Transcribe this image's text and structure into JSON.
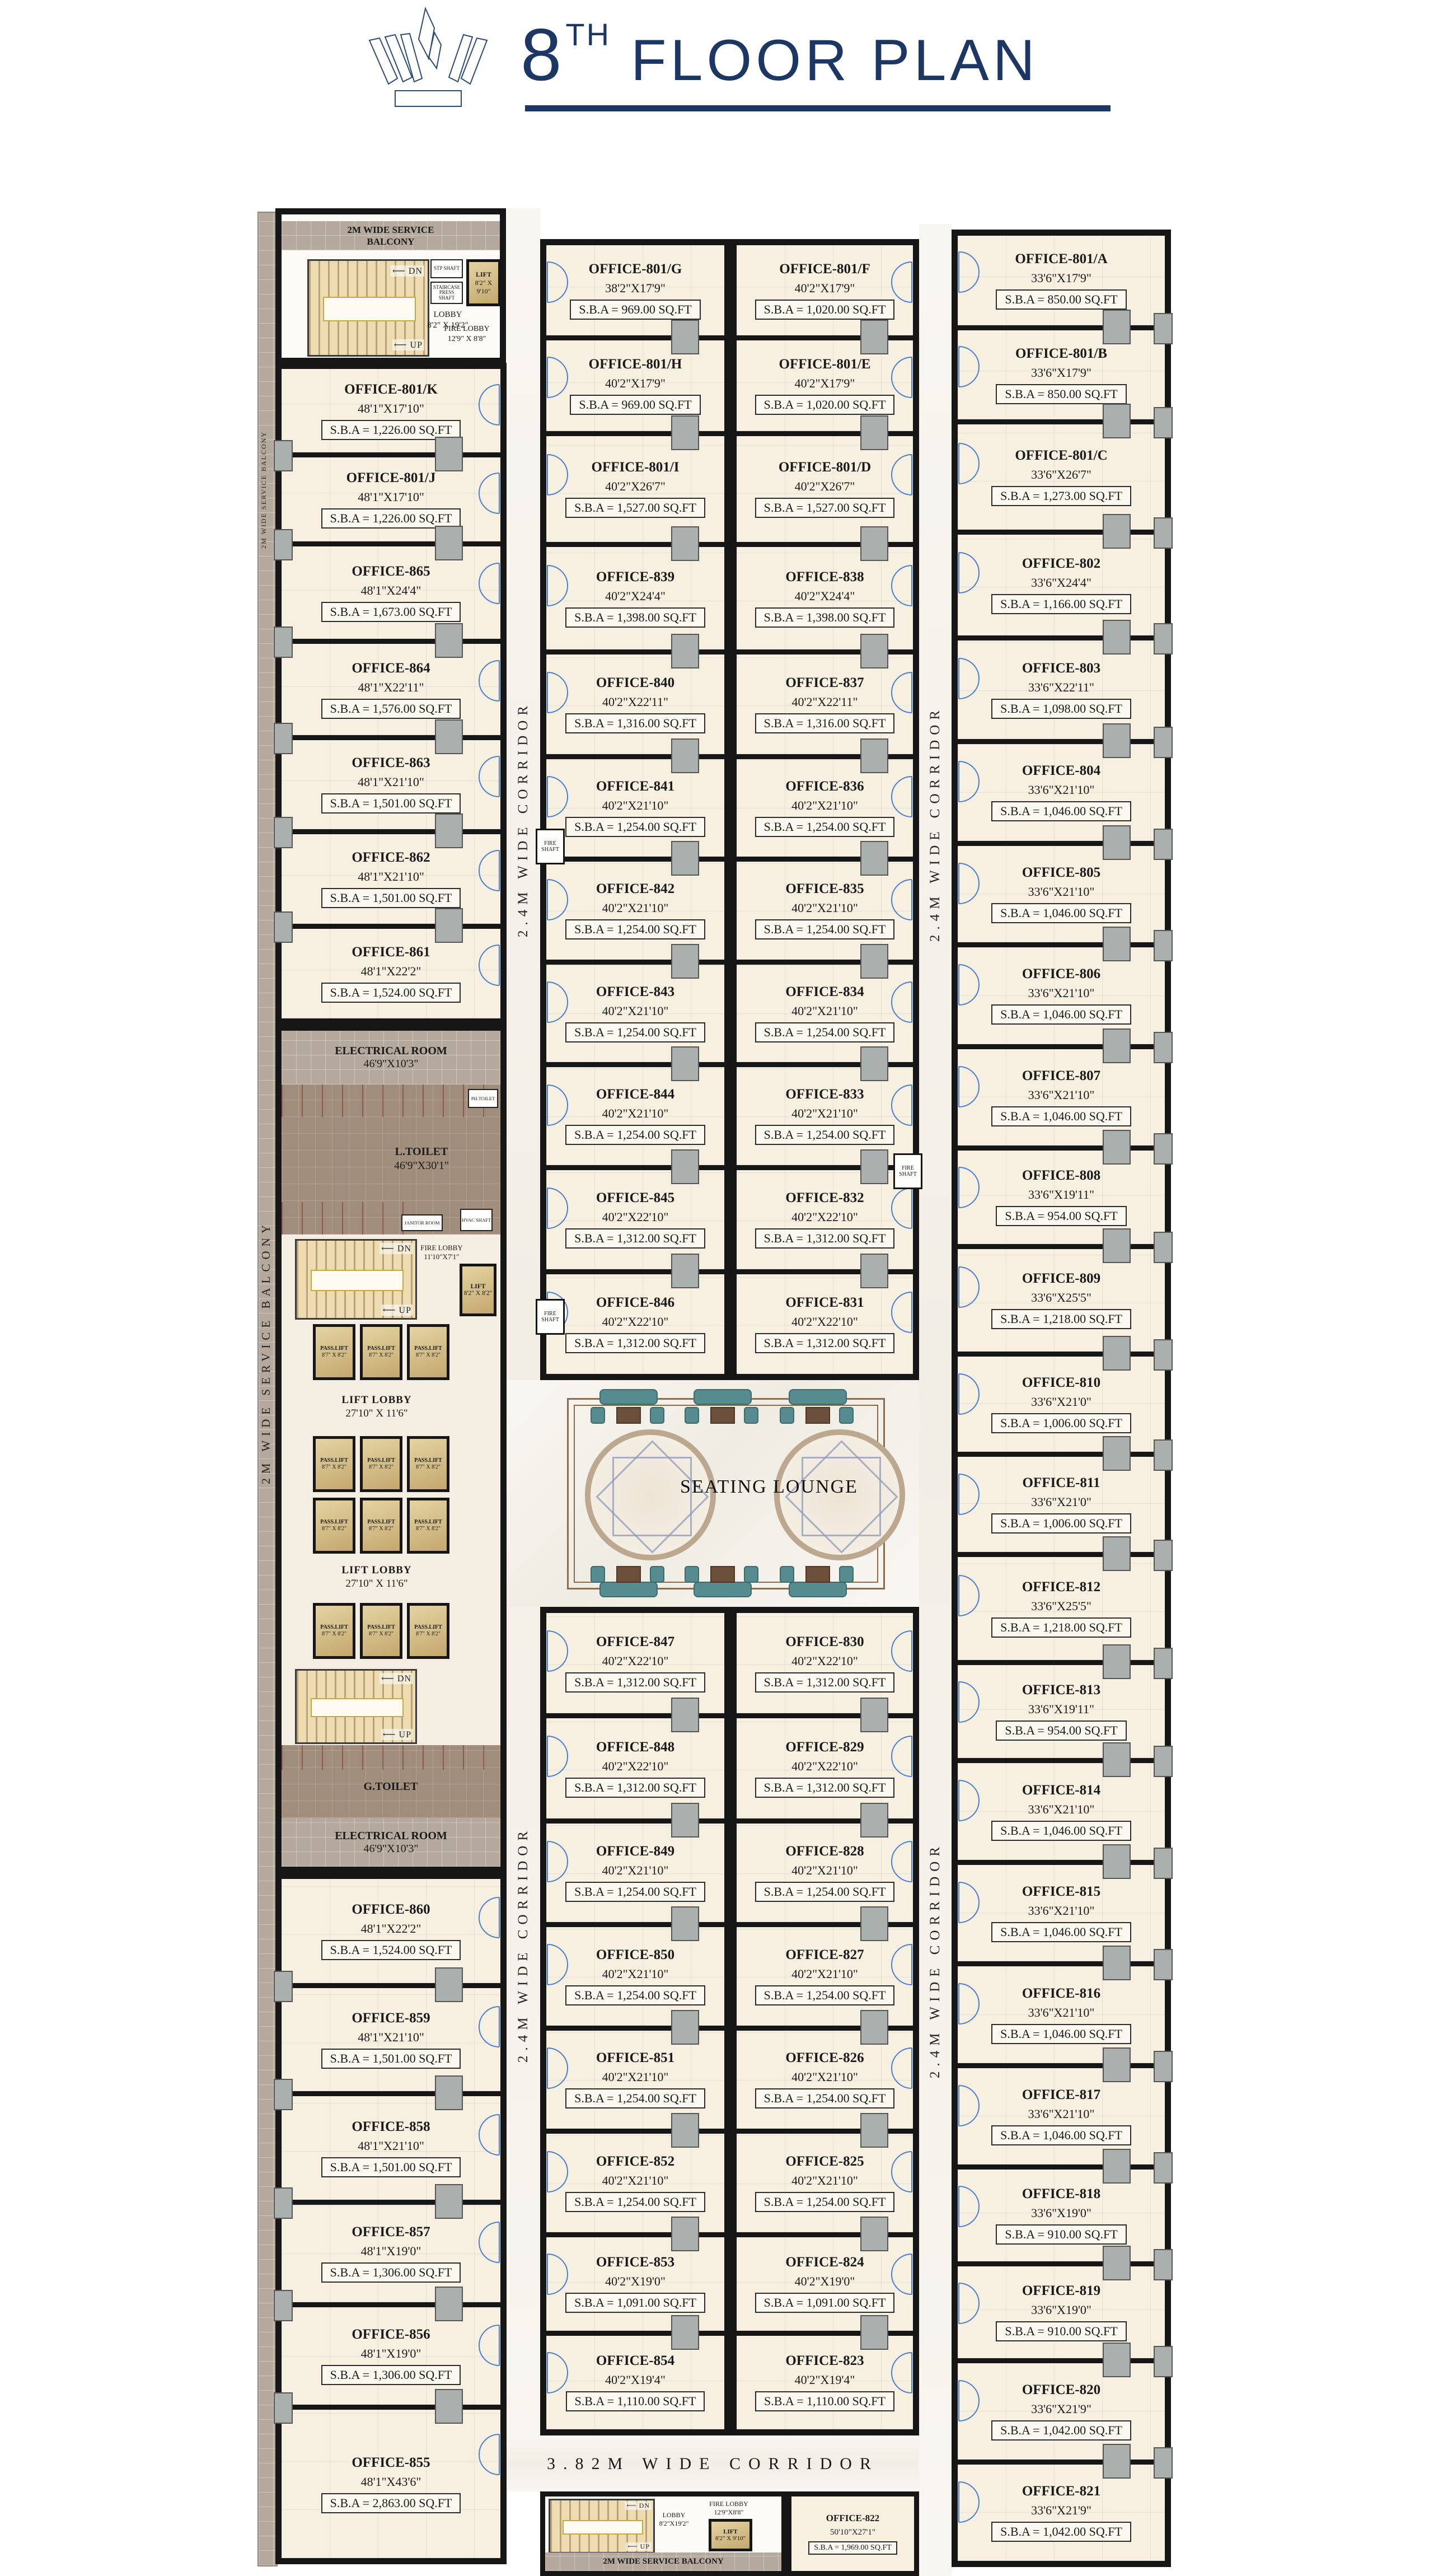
{
  "title": {
    "number": "8",
    "sup": "TH",
    "rest": " FLOOR PLAN"
  },
  "labels": {
    "corridor_24": "2.4M WIDE CORRIDOR",
    "corridor_382": "3.82M WIDE CORRIDOR",
    "service_balcony": "2M WIDE SERVICE BALCONY",
    "seating_lounge": "SEATING LOUNGE",
    "fire_shaft": "FIRE SHAFT"
  },
  "core_top": {
    "balcony": "2M WIDE SERVICE BALCONY",
    "dn": "DN",
    "up": "UP",
    "lobby": "LOBBY",
    "lobby_dims": "8'2\" X 19'2\"",
    "lift": "LIFT",
    "lift_dims": "8'2\" X 9'10\"",
    "fire_lobby": "FIRE LOBBY",
    "fire_lobby_dims": "12'9\" X 8'8\"",
    "stp_shaft": "STP SHAFT",
    "staircase_shaft": "STAIRCASE PRESS SHAFT"
  },
  "core_mid": {
    "electrical": "ELECTRICAL ROOM",
    "electrical_dims": "46'9\"X10'3\"",
    "l_toilet": "L.TOILET",
    "l_toilet_dims": "46'9\"X30'1\"",
    "ph_toilet": "PH.TOILET",
    "janitor": "JANITOR ROOM",
    "hvac": "HVAC SHAFT",
    "fire_lobby": "FIRE LOBBY",
    "fire_lobby_dims": "11'10\"X7'1\"",
    "lift": "LIFT",
    "lift_dims": "8'2\" X 8'2\"",
    "pass_lift": "PASS.LIFT",
    "pass_lift_dims": "8'7\" X 8'2\"",
    "lift_lobby": "LIFT LOBBY",
    "lift_lobby_dims": "27'10\" X 11'6\"",
    "g_toilet": "G.TOILET",
    "dn": "DN",
    "up": "UP"
  },
  "core_bottom": {
    "lobby": "LOBBY",
    "lobby_dims": "8'2\"X19'2\"",
    "fire_lobby": "FIRE LOBBY",
    "fire_lobby_dims": "12'9\"X8'8\"",
    "lift": "LIFT",
    "lift_dims": "8'2\" X 9'10\"",
    "balcony": "2M WIDE SERVICE BALCONY",
    "dn": "DN",
    "up": "UP"
  },
  "offices": {
    "left_top": [
      {
        "name": "OFFICE-801/K",
        "dims": "48'1\"X17'10\"",
        "sba": "S.B.A = 1,226.00 SQ.FT"
      },
      {
        "name": "OFFICE-801/J",
        "dims": "48'1\"X17'10\"",
        "sba": "S.B.A = 1,226.00 SQ.FT"
      },
      {
        "name": "OFFICE-865",
        "dims": "48'1\"X24'4\"",
        "sba": "S.B.A = 1,673.00 SQ.FT"
      },
      {
        "name": "OFFICE-864",
        "dims": "48'1\"X22'11\"",
        "sba": "S.B.A = 1,576.00 SQ.FT"
      },
      {
        "name": "OFFICE-863",
        "dims": "48'1\"X21'10\"",
        "sba": "S.B.A = 1,501.00 SQ.FT"
      },
      {
        "name": "OFFICE-862",
        "dims": "48'1\"X21'10\"",
        "sba": "S.B.A = 1,501.00 SQ.FT"
      },
      {
        "name": "OFFICE-861",
        "dims": "48'1\"X22'2\"",
        "sba": "S.B.A = 1,524.00 SQ.FT"
      }
    ],
    "left_bottom": [
      {
        "name": "OFFICE-860",
        "dims": "48'1\"X22'2\"",
        "sba": "S.B.A = 1,524.00 SQ.FT"
      },
      {
        "name": "OFFICE-859",
        "dims": "48'1\"X21'10\"",
        "sba": "S.B.A = 1,501.00 SQ.FT"
      },
      {
        "name": "OFFICE-858",
        "dims": "48'1\"X21'10\"",
        "sba": "S.B.A = 1,501.00 SQ.FT"
      },
      {
        "name": "OFFICE-857",
        "dims": "48'1\"X19'0\"",
        "sba": "S.B.A = 1,306.00 SQ.FT"
      },
      {
        "name": "OFFICE-856",
        "dims": "48'1\"X19'0\"",
        "sba": "S.B.A = 1,306.00 SQ.FT"
      },
      {
        "name": "OFFICE-855",
        "dims": "48'1\"X43'6\"",
        "sba": "S.B.A = 2,863.00 SQ.FT"
      }
    ],
    "mid_left_top": [
      {
        "name": "OFFICE-801/G",
        "dims": "38'2\"X17'9\"",
        "sba": "S.B.A = 969.00 SQ.FT"
      },
      {
        "name": "OFFICE-801/H",
        "dims": "40'2\"X17'9\"",
        "sba": "S.B.A = 969.00 SQ.FT"
      },
      {
        "name": "OFFICE-801/I",
        "dims": "40'2\"X26'7\"",
        "sba": "S.B.A = 1,527.00 SQ.FT"
      },
      {
        "name": "OFFICE-839",
        "dims": "40'2\"X24'4\"",
        "sba": "S.B.A = 1,398.00 SQ.FT"
      },
      {
        "name": "OFFICE-840",
        "dims": "40'2\"X22'11\"",
        "sba": "S.B.A = 1,316.00 SQ.FT"
      },
      {
        "name": "OFFICE-841",
        "dims": "40'2\"X21'10\"",
        "sba": "S.B.A = 1,254.00 SQ.FT"
      },
      {
        "name": "OFFICE-842",
        "dims": "40'2\"X21'10\"",
        "sba": "S.B.A = 1,254.00 SQ.FT"
      },
      {
        "name": "OFFICE-843",
        "dims": "40'2\"X21'10\"",
        "sba": "S.B.A = 1,254.00 SQ.FT"
      },
      {
        "name": "OFFICE-844",
        "dims": "40'2\"X21'10\"",
        "sba": "S.B.A = 1,254.00 SQ.FT"
      },
      {
        "name": "OFFICE-845",
        "dims": "40'2\"X22'10\"",
        "sba": "S.B.A = 1,312.00 SQ.FT"
      },
      {
        "name": "OFFICE-846",
        "dims": "40'2\"X22'10\"",
        "sba": "S.B.A = 1,312.00 SQ.FT"
      }
    ],
    "mid_right_top": [
      {
        "name": "OFFICE-801/F",
        "dims": "40'2\"X17'9\"",
        "sba": "S.B.A = 1,020.00 SQ.FT"
      },
      {
        "name": "OFFICE-801/E",
        "dims": "40'2\"X17'9\"",
        "sba": "S.B.A = 1,020.00 SQ.FT"
      },
      {
        "name": "OFFICE-801/D",
        "dims": "40'2\"X26'7\"",
        "sba": "S.B.A = 1,527.00 SQ.FT"
      },
      {
        "name": "OFFICE-838",
        "dims": "40'2\"X24'4\"",
        "sba": "S.B.A = 1,398.00 SQ.FT"
      },
      {
        "name": "OFFICE-837",
        "dims": "40'2\"X22'11\"",
        "sba": "S.B.A = 1,316.00 SQ.FT"
      },
      {
        "name": "OFFICE-836",
        "dims": "40'2\"X21'10\"",
        "sba": "S.B.A = 1,254.00 SQ.FT"
      },
      {
        "name": "OFFICE-835",
        "dims": "40'2\"X21'10\"",
        "sba": "S.B.A = 1,254.00 SQ.FT"
      },
      {
        "name": "OFFICE-834",
        "dims": "40'2\"X21'10\"",
        "sba": "S.B.A = 1,254.00 SQ.FT"
      },
      {
        "name": "OFFICE-833",
        "dims": "40'2\"X21'10\"",
        "sba": "S.B.A = 1,254.00 SQ.FT"
      },
      {
        "name": "OFFICE-832",
        "dims": "40'2\"X22'10\"",
        "sba": "S.B.A = 1,312.00 SQ.FT"
      },
      {
        "name": "OFFICE-831",
        "dims": "40'2\"X22'10\"",
        "sba": "S.B.A = 1,312.00 SQ.FT"
      }
    ],
    "mid_left_bottom": [
      {
        "name": "OFFICE-847",
        "dims": "40'2\"X22'10\"",
        "sba": "S.B.A = 1,312.00 SQ.FT"
      },
      {
        "name": "OFFICE-848",
        "dims": "40'2\"X22'10\"",
        "sba": "S.B.A = 1,312.00 SQ.FT"
      },
      {
        "name": "OFFICE-849",
        "dims": "40'2\"X21'10\"",
        "sba": "S.B.A = 1,254.00 SQ.FT"
      },
      {
        "name": "OFFICE-850",
        "dims": "40'2\"X21'10\"",
        "sba": "S.B.A = 1,254.00 SQ.FT"
      },
      {
        "name": "OFFICE-851",
        "dims": "40'2\"X21'10\"",
        "sba": "S.B.A = 1,254.00 SQ.FT"
      },
      {
        "name": "OFFICE-852",
        "dims": "40'2\"X21'10\"",
        "sba": "S.B.A = 1,254.00 SQ.FT"
      },
      {
        "name": "OFFICE-853",
        "dims": "40'2\"X19'0\"",
        "sba": "S.B.A = 1,091.00 SQ.FT"
      },
      {
        "name": "OFFICE-854",
        "dims": "40'2\"X19'4\"",
        "sba": "S.B.A = 1,110.00 SQ.FT"
      }
    ],
    "mid_right_bottom": [
      {
        "name": "OFFICE-830",
        "dims": "40'2\"X22'10\"",
        "sba": "S.B.A = 1,312.00 SQ.FT"
      },
      {
        "name": "OFFICE-829",
        "dims": "40'2\"X22'10\"",
        "sba": "S.B.A = 1,312.00 SQ.FT"
      },
      {
        "name": "OFFICE-828",
        "dims": "40'2\"X21'10\"",
        "sba": "S.B.A = 1,254.00 SQ.FT"
      },
      {
        "name": "OFFICE-827",
        "dims": "40'2\"X21'10\"",
        "sba": "S.B.A = 1,254.00 SQ.FT"
      },
      {
        "name": "OFFICE-826",
        "dims": "40'2\"X21'10\"",
        "sba": "S.B.A = 1,254.00 SQ.FT"
      },
      {
        "name": "OFFICE-825",
        "dims": "40'2\"X21'10\"",
        "sba": "S.B.A = 1,254.00 SQ.FT"
      },
      {
        "name": "OFFICE-824",
        "dims": "40'2\"X19'0\"",
        "sba": "S.B.A = 1,091.00 SQ.FT"
      },
      {
        "name": "OFFICE-823",
        "dims": "40'2\"X19'4\"",
        "sba": "S.B.A = 1,110.00 SQ.FT"
      }
    ],
    "right": [
      {
        "name": "OFFICE-801/A",
        "dims": "33'6\"X17'9\"",
        "sba": "S.B.A = 850.00 SQ.FT"
      },
      {
        "name": "OFFICE-801/B",
        "dims": "33'6\"X17'9\"",
        "sba": "S.B.A = 850.00 SQ.FT"
      },
      {
        "name": "OFFICE-801/C",
        "dims": "33'6\"X26'7\"",
        "sba": "S.B.A = 1,273.00 SQ.FT"
      },
      {
        "name": "OFFICE-802",
        "dims": "33'6\"X24'4\"",
        "sba": "S.B.A = 1,166.00 SQ.FT"
      },
      {
        "name": "OFFICE-803",
        "dims": "33'6\"X22'11\"",
        "sba": "S.B.A = 1,098.00 SQ.FT"
      },
      {
        "name": "OFFICE-804",
        "dims": "33'6\"X21'10\"",
        "sba": "S.B.A = 1,046.00 SQ.FT"
      },
      {
        "name": "OFFICE-805",
        "dims": "33'6\"X21'10\"",
        "sba": "S.B.A = 1,046.00 SQ.FT"
      },
      {
        "name": "OFFICE-806",
        "dims": "33'6\"X21'10\"",
        "sba": "S.B.A = 1,046.00 SQ.FT"
      },
      {
        "name": "OFFICE-807",
        "dims": "33'6\"X21'10\"",
        "sba": "S.B.A = 1,046.00 SQ.FT"
      },
      {
        "name": "OFFICE-808",
        "dims": "33'6\"X19'11\"",
        "sba": "S.B.A = 954.00 SQ.FT"
      },
      {
        "name": "OFFICE-809",
        "dims": "33'6\"X25'5\"",
        "sba": "S.B.A = 1,218.00 SQ.FT"
      },
      {
        "name": "OFFICE-810",
        "dims": "33'6\"X21'0\"",
        "sba": "S.B.A = 1,006.00 SQ.FT"
      },
      {
        "name": "OFFICE-811",
        "dims": "33'6\"X21'0\"",
        "sba": "S.B.A = 1,006.00 SQ.FT"
      },
      {
        "name": "OFFICE-812",
        "dims": "33'6\"X25'5\"",
        "sba": "S.B.A = 1,218.00 SQ.FT"
      },
      {
        "name": "OFFICE-813",
        "dims": "33'6\"X19'11\"",
        "sba": "S.B.A = 954.00 SQ.FT"
      },
      {
        "name": "OFFICE-814",
        "dims": "33'6\"X21'10\"",
        "sba": "S.B.A = 1,046.00 SQ.FT"
      },
      {
        "name": "OFFICE-815",
        "dims": "33'6\"X21'10\"",
        "sba": "S.B.A = 1,046.00 SQ.FT"
      },
      {
        "name": "OFFICE-816",
        "dims": "33'6\"X21'10\"",
        "sba": "S.B.A = 1,046.00 SQ.FT"
      },
      {
        "name": "OFFICE-817",
        "dims": "33'6\"X21'10\"",
        "sba": "S.B.A = 1,046.00 SQ.FT"
      },
      {
        "name": "OFFICE-818",
        "dims": "33'6\"X19'0\"",
        "sba": "S.B.A = 910.00 SQ.FT"
      },
      {
        "name": "OFFICE-819",
        "dims": "33'6\"X19'0\"",
        "sba": "S.B.A = 910.00 SQ.FT"
      },
      {
        "name": "OFFICE-820",
        "dims": "33'6\"X21'9\"",
        "sba": "S.B.A = 1,042.00 SQ.FT"
      },
      {
        "name": "OFFICE-821",
        "dims": "33'6\"X21'9\"",
        "sba": "S.B.A = 1,042.00 SQ.FT"
      }
    ],
    "office_822": {
      "name": "OFFICE-822",
      "dims": "50'10\"X27'1\"",
      "sba": "S.B.A = 1,969.00 SQ.FT"
    }
  }
}
